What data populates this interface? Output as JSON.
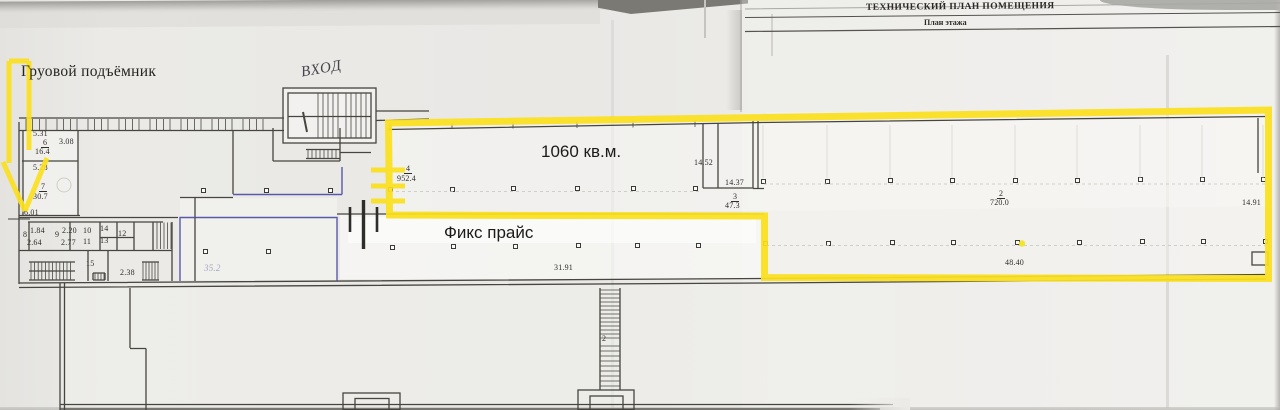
{
  "document": {
    "title": "ТЕХНИЧЕСКИЙ ПЛАН ПОМЕЩЕНИЯ",
    "subtitle": "План этажа"
  },
  "annotations": {
    "cargo_lift_label": "Груовой подъёмник",
    "entrance_note": "ВХОД",
    "area_label": "1060 кв.м.",
    "tenant_label": "Фикс прайс",
    "highlight_color": "#fbe01e",
    "secondary_outline_color": "#4a4aa6"
  },
  "plan": {
    "dimension_labels": [
      {
        "t": "5.31",
        "x": 33,
        "y": 130
      },
      {
        "t": "6",
        "x": 41,
        "y": 139,
        "u": 1
      },
      {
        "t": "3.08",
        "x": 59,
        "y": 138
      },
      {
        "t": "16.4",
        "x": 35,
        "y": 148
      },
      {
        "t": "5.28",
        "x": 33,
        "y": 164
      },
      {
        "t": "7",
        "x": 39,
        "y": 183,
        "u": 1
      },
      {
        "t": "30.7",
        "x": 33,
        "y": 193
      },
      {
        "t": "6.01",
        "x": 24,
        "y": 209
      },
      {
        "t": "8",
        "x": 23,
        "y": 231
      },
      {
        "t": "1.84",
        "x": 30,
        "y": 227
      },
      {
        "t": "2.64",
        "x": 27,
        "y": 239
      },
      {
        "t": "9",
        "x": 55,
        "y": 231
      },
      {
        "t": "2.20",
        "x": 62,
        "y": 227
      },
      {
        "t": "2.77",
        "x": 61,
        "y": 239
      },
      {
        "t": "10",
        "x": 83,
        "y": 227
      },
      {
        "t": "11",
        "x": 83,
        "y": 238
      },
      {
        "t": "14",
        "x": 100,
        "y": 225
      },
      {
        "t": "13",
        "x": 100,
        "y": 237
      },
      {
        "t": "12",
        "x": 118,
        "y": 230
      },
      {
        "t": "15",
        "x": 86,
        "y": 260
      },
      {
        "t": "2.38",
        "x": 120,
        "y": 269
      },
      {
        "t": "4",
        "x": 404,
        "y": 165,
        "u": 1
      },
      {
        "t": "952.4",
        "x": 397,
        "y": 175
      },
      {
        "t": "14.52",
        "x": 694,
        "y": 159
      },
      {
        "t": "14.37",
        "x": 725,
        "y": 179
      },
      {
        "t": "3",
        "x": 731,
        "y": 193,
        "u": 1
      },
      {
        "t": "47.3",
        "x": 725,
        "y": 202
      },
      {
        "t": "2",
        "x": 997,
        "y": 190,
        "u": 1
      },
      {
        "t": "720.0",
        "x": 990,
        "y": 199
      },
      {
        "t": "14.91",
        "x": 1242,
        "y": 199
      },
      {
        "t": "48.40",
        "x": 1005,
        "y": 259
      },
      {
        "t": "31.91",
        "x": 554,
        "y": 264
      },
      {
        "t": "2",
        "x": 602,
        "y": 335
      },
      {
        "t": "35.2",
        "x": 204,
        "y": 264,
        "cls": "hand"
      }
    ],
    "columns": [
      [
        203,
        190
      ],
      [
        266,
        190
      ],
      [
        330,
        190
      ],
      [
        390,
        189
      ],
      [
        452,
        189
      ],
      [
        513,
        188
      ],
      [
        577,
        188
      ],
      [
        633,
        188
      ],
      [
        695,
        188
      ],
      [
        763,
        181
      ],
      [
        827,
        181
      ],
      [
        890,
        180
      ],
      [
        952,
        180
      ],
      [
        1015,
        180
      ],
      [
        1077,
        180
      ],
      [
        1140,
        179
      ],
      [
        1202,
        179
      ],
      [
        1263,
        179
      ],
      [
        205,
        251
      ],
      [
        268,
        251
      ],
      [
        392,
        247
      ],
      [
        453,
        246
      ],
      [
        515,
        246
      ],
      [
        578,
        245
      ],
      [
        637,
        245
      ],
      [
        698,
        245
      ],
      [
        765,
        243
      ],
      [
        828,
        243
      ],
      [
        892,
        242
      ],
      [
        953,
        242
      ],
      [
        1017,
        242
      ],
      [
        1079,
        242
      ],
      [
        1142,
        241
      ],
      [
        1203,
        241
      ],
      [
        1265,
        241
      ]
    ],
    "yellow_dot": [
      1022,
      243
    ]
  }
}
